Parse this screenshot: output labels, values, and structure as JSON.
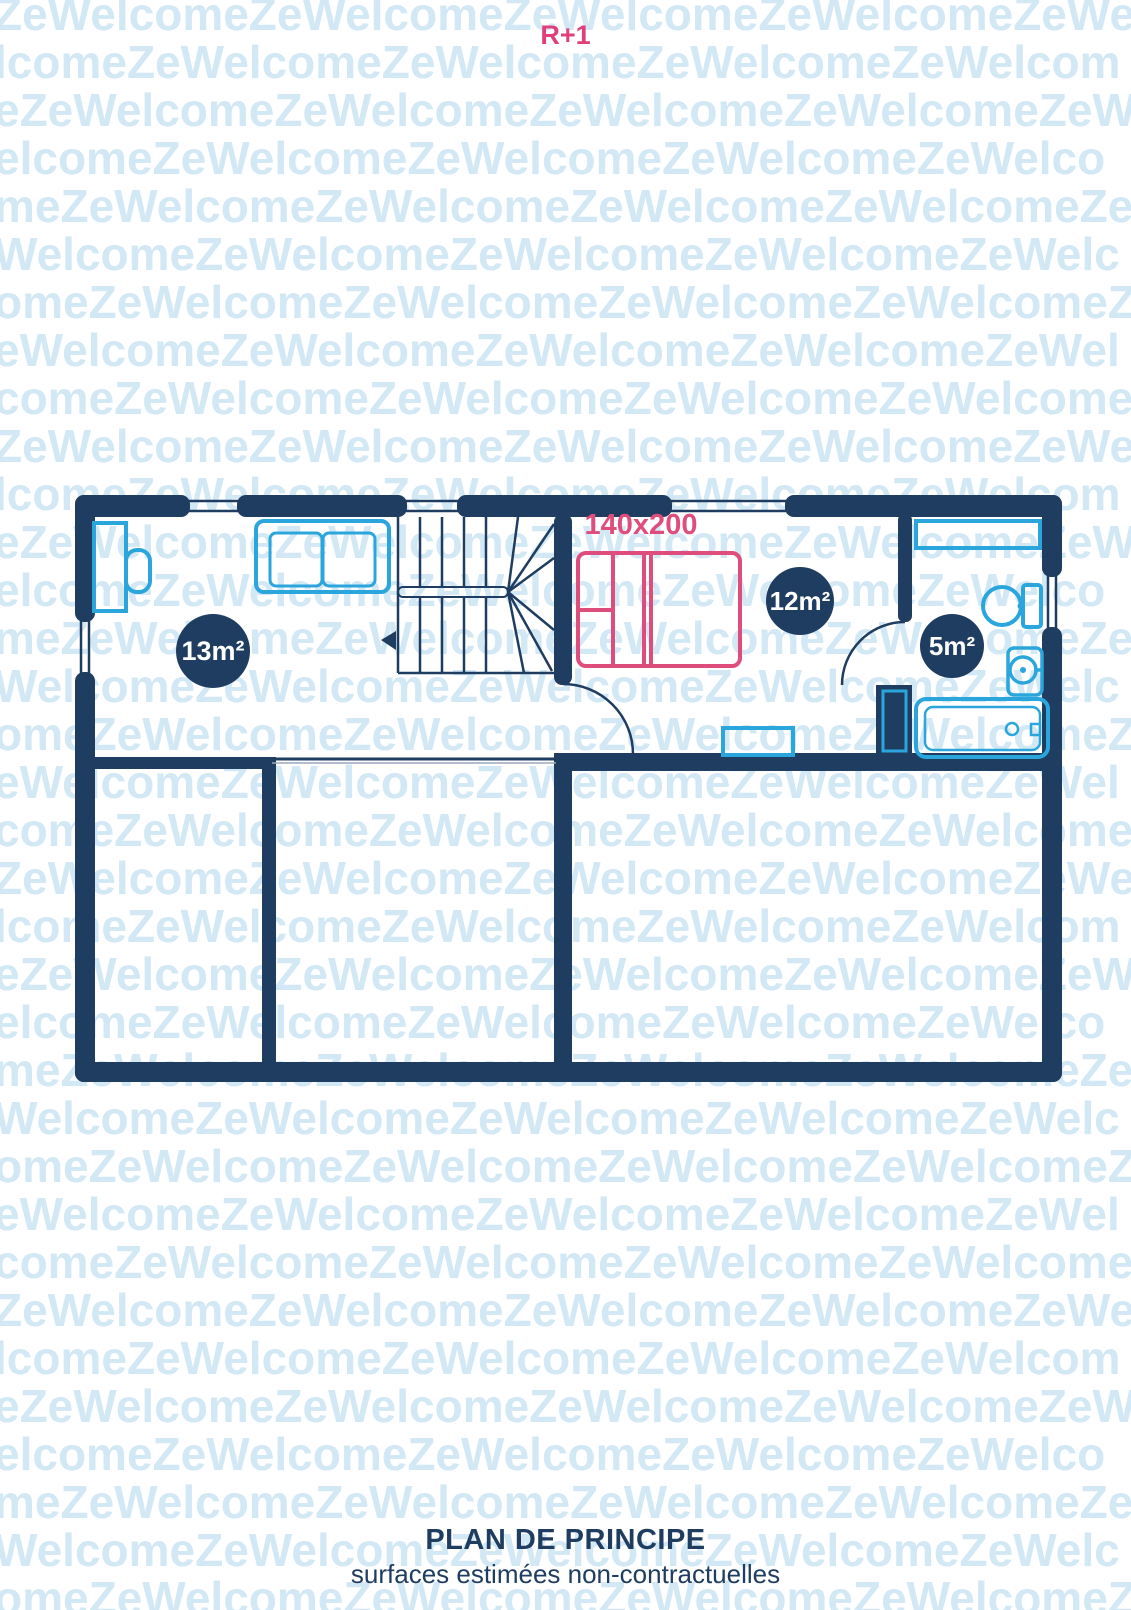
{
  "floor_label": "R+1",
  "watermark": {
    "text": "ZeWelcome"
  },
  "plan": {
    "rooms": [
      {
        "label": "13m²"
      },
      {
        "label": "12m²"
      },
      {
        "label": "5m²"
      }
    ],
    "bed_label": "140x200"
  },
  "footer": {
    "title": "PLAN DE PRINCIPE",
    "subtitle": "surfaces estimées non-contractuelles"
  },
  "colors": {
    "navy": "#1f3d60",
    "light_blue": "#2ba6dc",
    "pink": "#de4d7b",
    "watermark_blue": "#d2e8f5"
  }
}
